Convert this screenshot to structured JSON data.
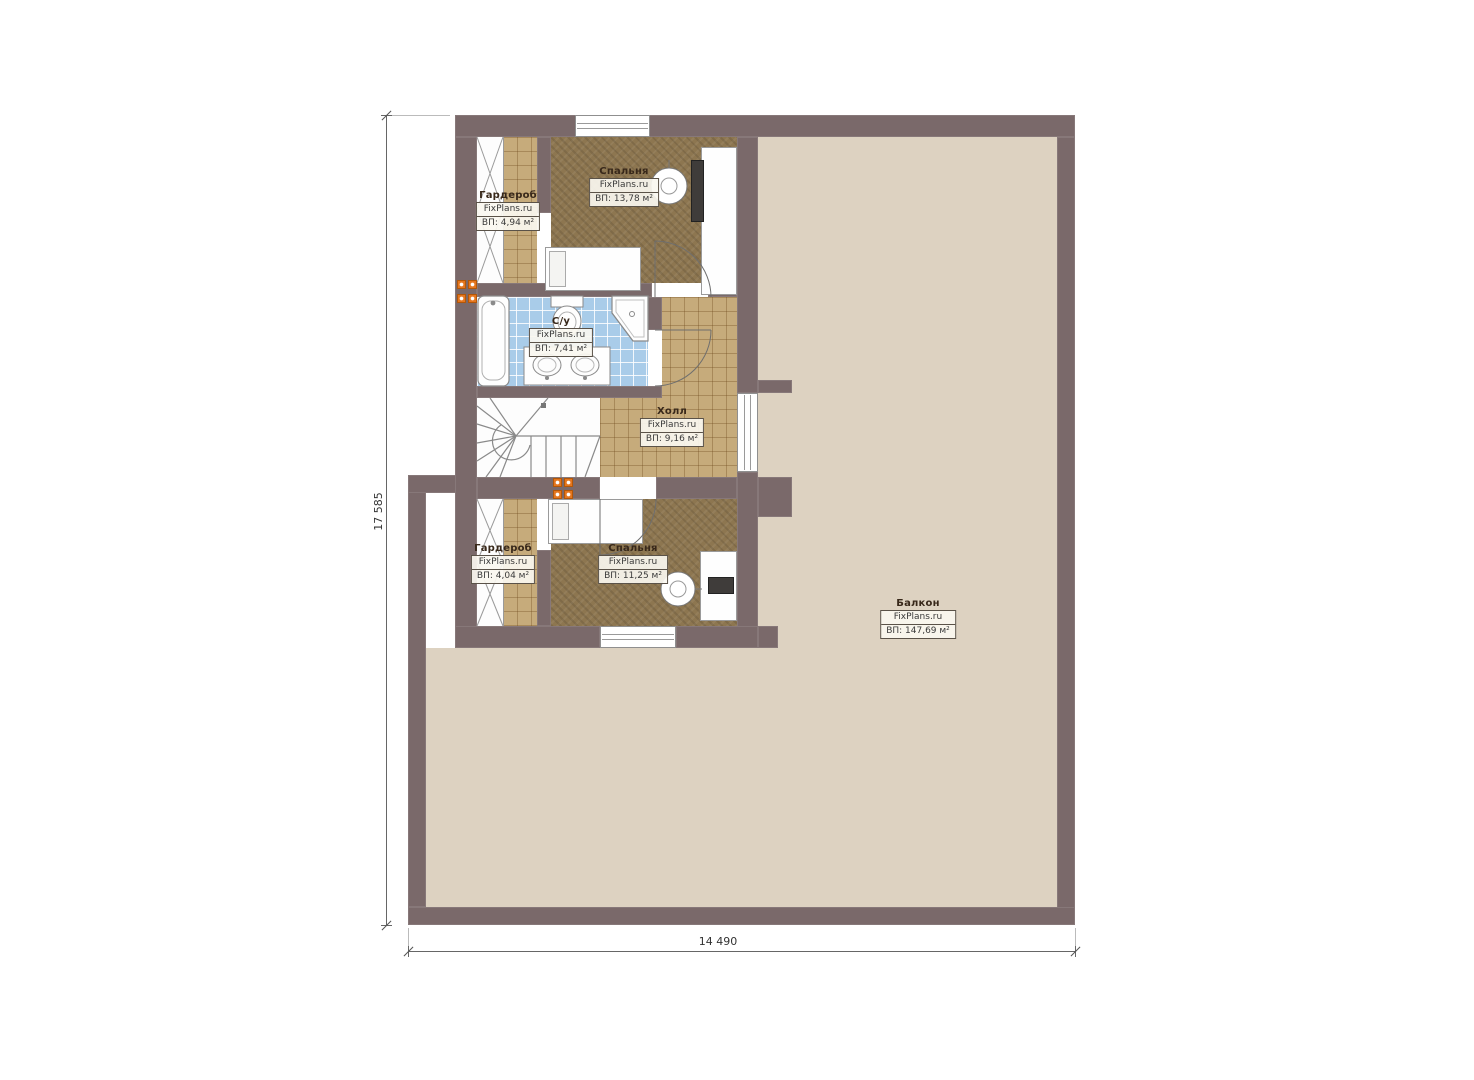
{
  "plan": {
    "title": "Second floor plan",
    "brand": "FixPlans.ru",
    "dimensions": {
      "height_label": "17 585",
      "width_label": "14 490"
    },
    "rooms": {
      "wardrobe_top": {
        "name": "Гардероб",
        "brand": "FixPlans.ru",
        "area": "ВП: 4,94 м²"
      },
      "bedroom_top": {
        "name": "Спальня",
        "brand": "FixPlans.ru",
        "area": "ВП: 13,78 м²"
      },
      "bathroom": {
        "name": "С/у",
        "brand": "FixPlans.ru",
        "area": "ВП: 7,41 м²"
      },
      "hall": {
        "name": "Холл",
        "brand": "FixPlans.ru",
        "area": "ВП: 9,16 м²"
      },
      "wardrobe_bottom": {
        "name": "Гардероб",
        "brand": "FixPlans.ru",
        "area": "ВП: 4,04 м²"
      },
      "bedroom_bottom": {
        "name": "Спальня",
        "brand": "FixPlans.ru",
        "area": "ВП: 11,25 м²"
      },
      "balcony": {
        "name": "Балкон",
        "brand": "FixPlans.ru",
        "area": "ВП: 147,69 м²"
      }
    },
    "colors": {
      "wall": "#7a696a",
      "balcony_floor": "#ddd2c1",
      "carpet": "#8d7650",
      "tile_tan": "#c6ab7b",
      "tile_blue": "#a9cce9",
      "marker_orange": "#e5761e"
    }
  }
}
